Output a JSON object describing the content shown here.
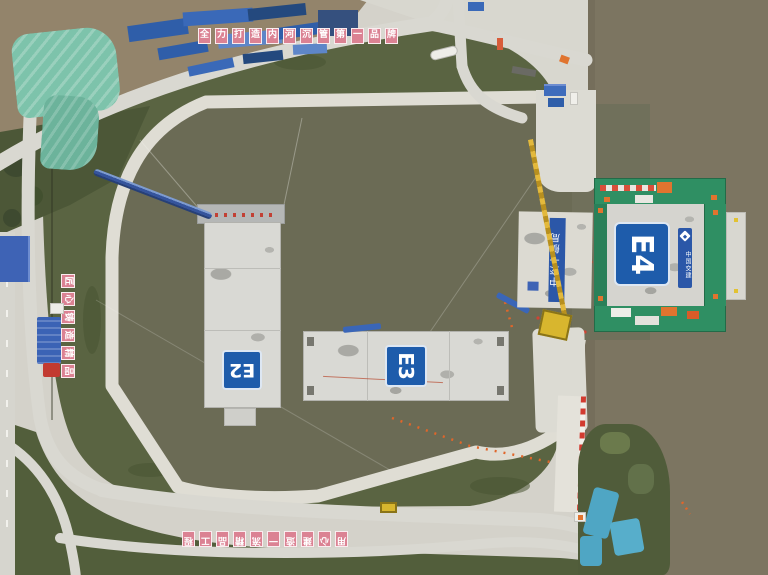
{
  "photo": {
    "caissons": {
      "e2": "E2",
      "e3": "E3",
      "e4": "E4"
    },
    "banners": {
      "bureau": "中交一航局",
      "company": "中国交建"
    },
    "slogans": {
      "top": [
        "全",
        "力",
        "打",
        "造",
        "内",
        "河",
        "沉",
        "管",
        "第",
        "一",
        "品",
        "牌"
      ],
      "bottom": [
        "用",
        "心",
        "建",
        "造",
        "一",
        "流",
        "精",
        "品",
        "工",
        "程"
      ],
      "left": [
        "匠",
        "心",
        "铸",
        "造",
        "精",
        "品"
      ]
    },
    "colors": {
      "basin_water": "#6B6B55",
      "river": "#7C7561",
      "quay_concrete": "#DFDDD4",
      "grass": "#5A6442",
      "caisson_concrete": "#D9D9D4",
      "label_blue": "#1E5CAB",
      "dock_green": "#2F8F63",
      "equipment_orange": "#E0742F",
      "sign_pink": "#DB8293",
      "walkway_blue": "#35549C",
      "tarp_teal": "#7DC3AB",
      "tarp_blue": "#54ABC6",
      "steel_blue": "#2F5EA9",
      "crane_yellow": "#E3B93C"
    }
  }
}
